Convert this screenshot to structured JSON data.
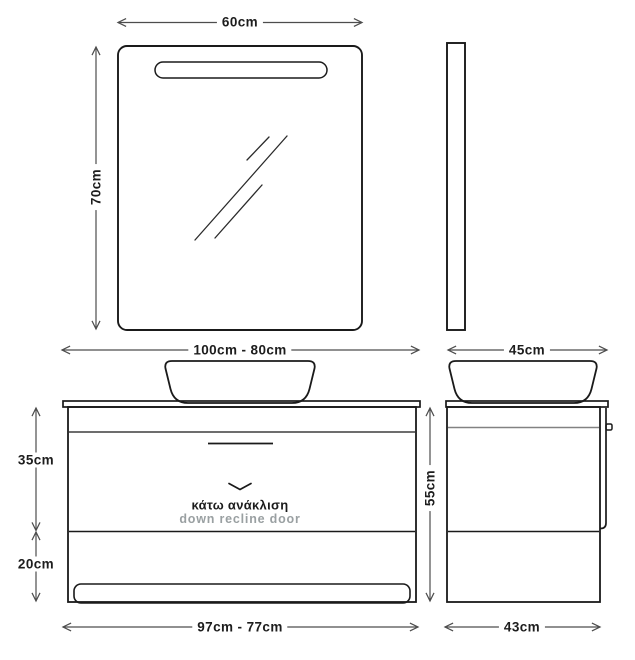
{
  "title": "bathroom-vanity-technical-drawing",
  "colors": {
    "background": "#ffffff",
    "outline": "#1a1a1a",
    "dimension_line": "#4d4d4d",
    "inner_edge_gray": "#828282",
    "muted_text": "#9aa0a2"
  },
  "dimensions": {
    "mirror_width": "60cm",
    "mirror_height": "70cm",
    "cabinet_top_width_range": "100cm - 80cm",
    "cabinet_depth_top": "45cm",
    "upper_section_height": "35cm",
    "lower_section_height": "20cm",
    "cabinet_total_height": "55cm",
    "cabinet_bottom_width_range": "97cm - 77cm",
    "cabinet_depth_bottom": "43cm"
  },
  "annotations": {
    "door_note_greek": "κάτω ανάκλιση",
    "door_note_english": "down recline door"
  }
}
